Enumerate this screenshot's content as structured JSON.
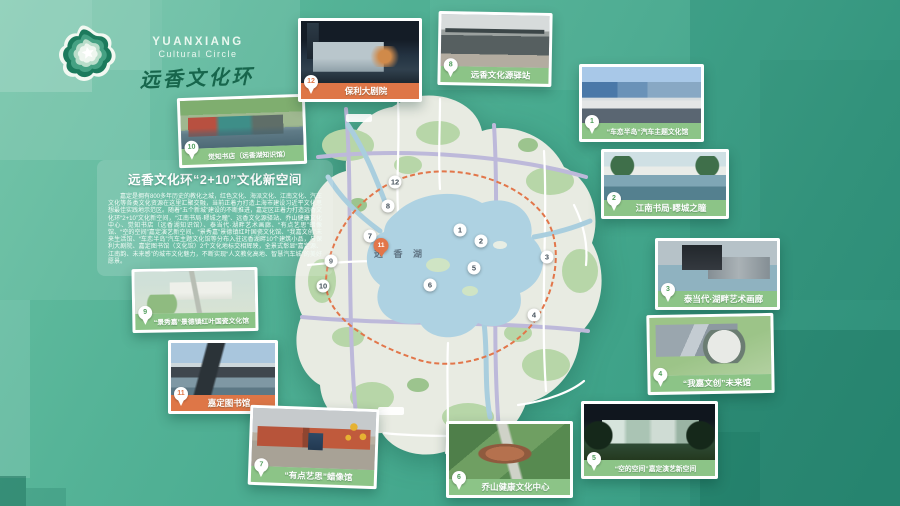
{
  "logo": {
    "latin_line1": "YUANXIANG",
    "latin_line2": "Cultural Circle",
    "calligraphy": "远香文化环",
    "star_icon": "star-blob-icon"
  },
  "intro": {
    "title": "远香文化环“2+10”文化新空间",
    "body": "嘉定是拥有800多年历史的教化之城，红色文化、海派文化、江南文化、汽车文化等各类文化资源在这里汇聚交融，当前正着力打造上海市建设习近平文化思想最佳实践地示范区。随着“五个新城”建设的不断推进，嘉定区正着力打造远香文化环“2+10”文化新空间，“江南书局·疁城之瞳”、远香文化源驿站、乔山健康文化中心、觉知书店（远香湖知识馆）、泰当代·湖畔艺术画廊、“有点艺思”蜡像馆、“空的空间”嘉定演艺新空间、“景秀嘉”景德镇红叶国瓷文化馆、“我嘉文创”未来生活馆、“车恋半岛”汽车主题文化馆等分布入驻远香湖畔10个建筑小品，与保利大剧院、嘉定图书馆（文化馆）2个文化地标交相辉映，全景式彰显“嘉定源、江南韵、未来感”的城市文化魅力，不断实现“人文教化高地、智慧汽车城”的美好愿景。"
  },
  "map": {
    "lake_label": "远 香 湖",
    "markers": [
      "1",
      "2",
      "3",
      "4",
      "5",
      "6",
      "7",
      "8",
      "9",
      "10",
      "11",
      "12"
    ]
  },
  "cards": [
    {
      "badge": "10",
      "label": "觉知书店（远香湖知识馆）"
    },
    {
      "badge": "9",
      "label": "“景秀嘉”景德镇红叶国瓷文化馆"
    },
    {
      "badge": "11",
      "label": "嘉定图书馆"
    },
    {
      "badge": "12",
      "label": "保利大剧院"
    },
    {
      "badge": "8",
      "label": "远香文化源驿站"
    },
    {
      "badge": "1",
      "label": "“车恋半岛”汽车主题文化馆"
    },
    {
      "badge": "2",
      "label": "江南书局·疁城之瞳"
    },
    {
      "badge": "3",
      "label": "泰当代·湖畔艺术画廊"
    },
    {
      "badge": "4",
      "label": "“我嘉文创”未来馆"
    },
    {
      "badge": "5",
      "label": "“空的空间”嘉定演艺新空间"
    },
    {
      "badge": "6",
      "label": "乔山健康文化中心"
    },
    {
      "badge": "7",
      "label": "“有点艺思”蜡像馆"
    }
  ],
  "colors": {
    "background_teal": "#46a98e",
    "label_green": "#8cc487",
    "label_orange": "#de7647",
    "route_orange": "#e2764a",
    "lake_blue": "#aed2e2",
    "district_grey": "#e8ebe2"
  }
}
